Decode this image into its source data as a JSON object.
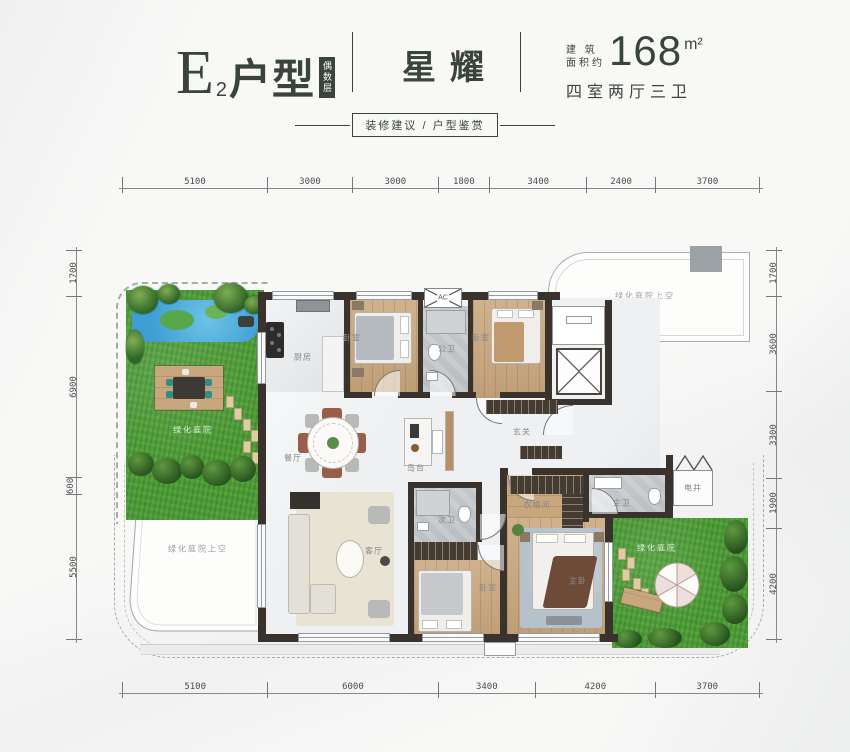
{
  "header": {
    "unit_letter": "E",
    "unit_sub": "2",
    "unit_suffix": "户型",
    "floor_badge": "偶数层",
    "name": "星耀",
    "area_caption": "建 筑\n面积约",
    "area_value": "168",
    "area_unit": "m²",
    "layout_desc": "四室两厅三卫"
  },
  "subtitle": {
    "label": "装修建议 / 户型鉴赏"
  },
  "dimensions": {
    "top": [
      "5100",
      "3000",
      "3000",
      "1800",
      "3400",
      "2400",
      "3700"
    ],
    "bottom": [
      "5100",
      "6000",
      "3400",
      "4200",
      "3700"
    ],
    "left": [
      "1700",
      "6900",
      "600",
      "5500"
    ],
    "right": [
      "1700",
      "3600",
      "3300",
      "1900",
      "4200"
    ]
  },
  "rooms": {
    "garden_top_left": "绿化庭院",
    "garden_bottom_right": "绿化庭院",
    "void_top_right": "绿化庭院上空",
    "void_bottom_left": "绿化庭院上空",
    "kitchen": "厨房",
    "bedroom_top_left": "卧室",
    "bedroom_top_right": "卧室",
    "bedroom_bottom": "卧室",
    "public_bath": "公卫",
    "second_bath": "次卫",
    "master_bath": "主卫",
    "master_bedroom": "主卧",
    "cloakroom": "衣帽间",
    "foyer": "玄关",
    "dining": "餐厅",
    "island": "岛台",
    "living": "客厅",
    "shaft": "电井",
    "ac": "AC"
  },
  "colors": {
    "ink": "#39443c",
    "wall": "#3a332d",
    "grass": "#4c9b38",
    "wood": "#c9a77e",
    "bath_tile": "#b9bdc1",
    "marble": "#eef0f2",
    "pond": "#3f9fd4"
  }
}
